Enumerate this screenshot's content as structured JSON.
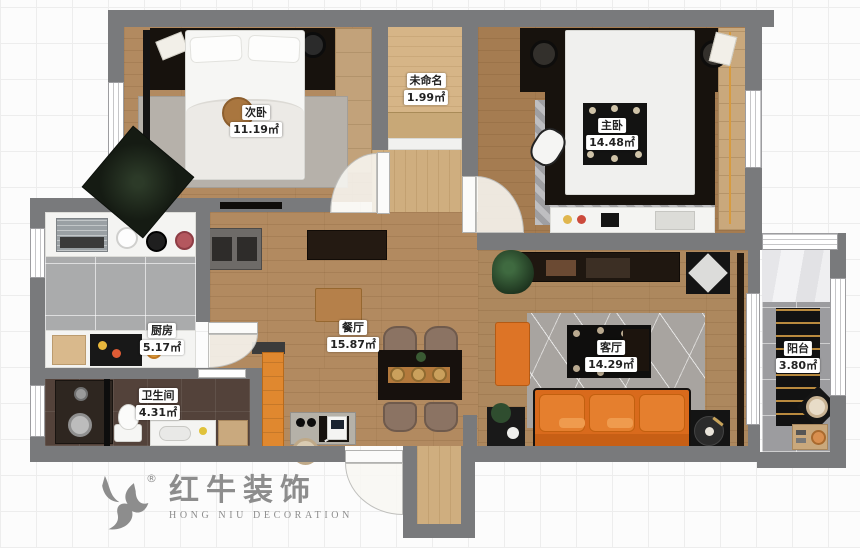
{
  "canvas": {
    "width": 860,
    "height": 548
  },
  "palette": {
    "wall_gray": "#797a7c",
    "wood_floor": "#b28a60",
    "light_wood": "#d6b587",
    "kitchen_tile": "#aaabac",
    "bathroom_tile": "#53423a",
    "balcony_tile": "#9c9c9f",
    "accent_orange": "#dd6f1f",
    "logo_gray": "#8d8d8d"
  },
  "rooms": [
    {
      "name": "次卧",
      "area": "11.19㎡"
    },
    {
      "name": "未命名",
      "area": "1.99㎡"
    },
    {
      "name": "主卧",
      "area": "14.48㎡"
    },
    {
      "name": "厨房",
      "area": "5.17㎡"
    },
    {
      "name": "餐厅",
      "area": "15.87㎡"
    },
    {
      "name": "客厅",
      "area": "14.29㎡"
    },
    {
      "name": "卫生间",
      "area": "4.31㎡"
    },
    {
      "name": "阳台",
      "area": "3.80㎡"
    }
  ],
  "logo": {
    "icon": "bull-icon",
    "registered": "®",
    "brand_cn": "红牛装饰",
    "brand_en": "HONG NIU DECORATION"
  }
}
